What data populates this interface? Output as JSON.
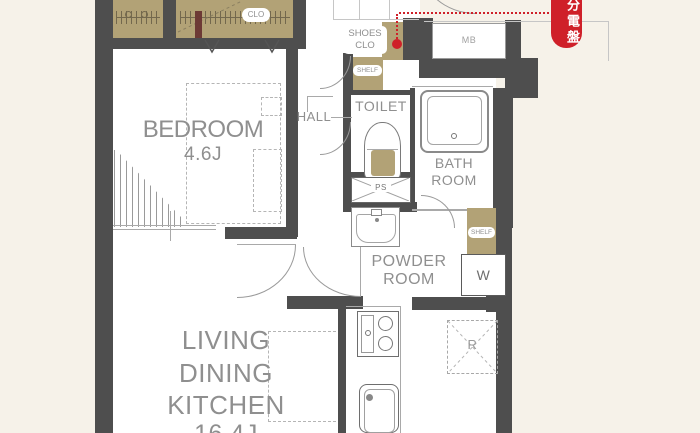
{
  "colors": {
    "background": "#f6f2e9",
    "wall": "#4e4e4e",
    "closet_tan": "#b2a276",
    "accent_red": "#cf2029",
    "label_gray": "#8f8f8f"
  },
  "rooms": {
    "bedroom": {
      "name": "BEDROOM",
      "size": "4.6J"
    },
    "living_dining_kitchen": {
      "line1": "LIVING",
      "line2": "DINING",
      "line3": "KITCHEN",
      "size": "16.4J"
    },
    "toilet": {
      "name": "TOILET"
    },
    "bathroom": {
      "line1": "BATH",
      "line2": "ROOM"
    },
    "powder_room": {
      "line1": "POWDER",
      "line2": "ROOM"
    },
    "hall": {
      "name": "HALL"
    },
    "entry": {
      "name": "ENTRY"
    }
  },
  "fixtures": {
    "closet": "CLO",
    "shoes_closet": {
      "line1": "SHOES",
      "line2": "CLO"
    },
    "shelf_upper": "SHELF",
    "shelf_lower": "SHELF",
    "meter_box": "MB",
    "pipe_space": "PS",
    "washing_machine": "W",
    "refrigerator": "R"
  },
  "annotations": {
    "distribution_board": "分電盤"
  }
}
